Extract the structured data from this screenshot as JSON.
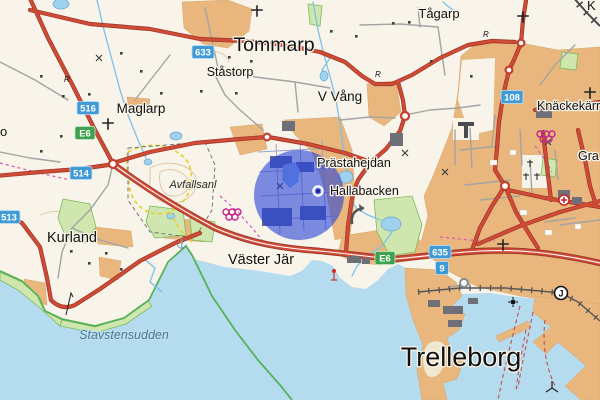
{
  "map": {
    "description": "Topographic web map of Trelleborg area, Sweden, with blue search highlight circle",
    "labels": {
      "tommarp": "Tommarp",
      "tagarp": "Tågarp",
      "stastorp": "Ståstorp",
      "maglarp": "Maglarp",
      "v_vang": "V Vång",
      "knackekarr": "Knäckekärr",
      "gra_partial": "Gra",
      "prastahejdan": "Prästahejdan",
      "hallabacken": "Hallabacken",
      "avfallsanl": "Avfallsanl",
      "kurland": "Kurland",
      "vaster_jar": "Väster Jär",
      "trelleborg": "Trelleborg",
      "stavstensudden": "Stavstensudden",
      "o_partial": "o",
      "k_partial": "K"
    },
    "shields": {
      "r633": "633",
      "r516": "516",
      "e6": "E6",
      "r514": "514",
      "r513": "513",
      "r108": "108",
      "r635": "635",
      "r9": "9"
    },
    "symbols": {
      "station": "J",
      "ruin": "R",
      "anchor": "⚓"
    },
    "colors": {
      "land": "#f8f4ea",
      "sea": "#b5dbef",
      "urban": "#e9b77d",
      "green_area": "#cfe7ae",
      "road_major": "#d04b36",
      "shield_blue": "#3f9ad6",
      "shield_green": "#3da24e",
      "highlight_circle": "#2842d7",
      "boundary_green": "#57b257",
      "rings_magenta": "#c2268e",
      "trail_yellow": "#e6d23c"
    }
  }
}
